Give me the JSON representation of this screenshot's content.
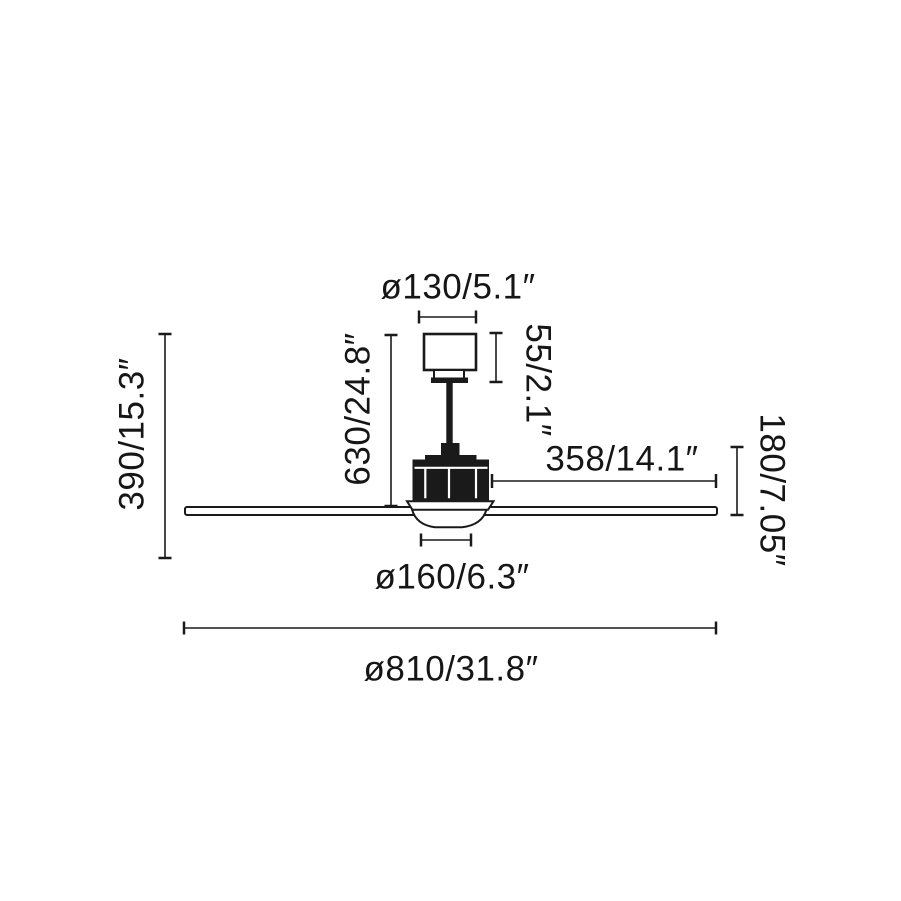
{
  "diagram": {
    "colors": {
      "line": "#1a1a1a",
      "background": "#ffffff"
    }
  },
  "labels": {
    "canopy_diameter": "ø130/5.1″",
    "canopy_height": "55/2.1″",
    "drop_height": "630/24.8″",
    "overall_height": "390/15.3″",
    "blade_length": "358/14.1″",
    "body_height": "180/7.05″",
    "light_diameter": "ø160/6.3″",
    "total_diameter": "ø810/31.8″"
  }
}
